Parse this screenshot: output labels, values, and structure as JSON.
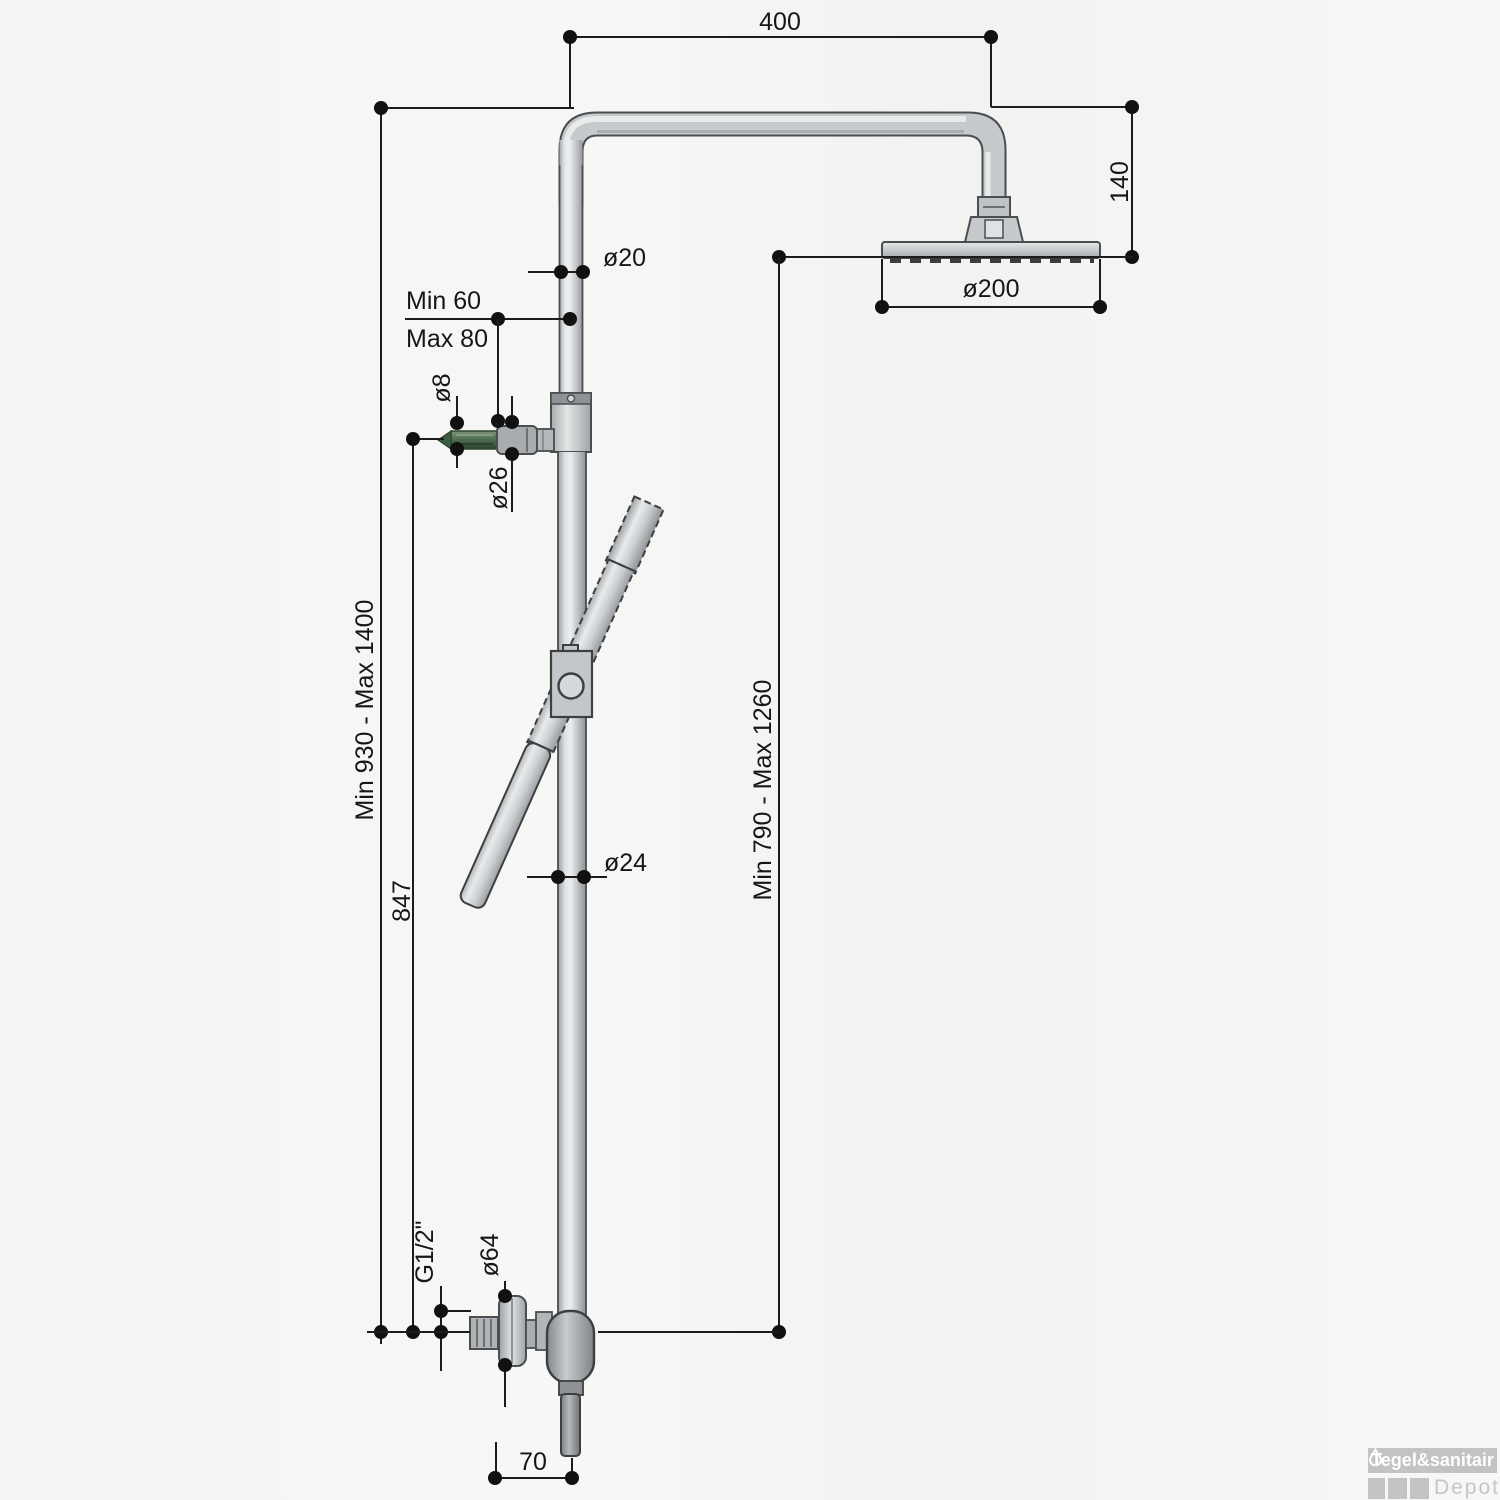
{
  "drawing": {
    "type": "technical-dimension-diagram",
    "subject": "shower column with rain shower head, hand shower and wall-mounted mixer",
    "units": "mm",
    "dimensions": {
      "arm_width": "400",
      "head_drop": "140",
      "riser_upper_diameter": "ø20",
      "wall_bracket_min": "Min 60",
      "wall_bracket_max": "Max 80",
      "bracket_screw_diameter": "ø8",
      "bracket_collar_diameter": "ø26",
      "head_diameter": "ø200",
      "column_height_range": "Min 930 - Max 1400",
      "bracket_height": "847",
      "riser_lower_diameter": "ø24",
      "head_height_range": "Min 790 - Max 1260",
      "inlet_thread": "G1/2\"",
      "mixer_flange_diameter": "ø64",
      "hose_offset": "70"
    },
    "colors": {
      "line": "#1c1c1c",
      "metal_light": "#eceeef",
      "metal_mid": "#c3c7ca",
      "metal_dark": "#84888b",
      "screw_green": "#44634a"
    }
  },
  "logo": {
    "brand": "Tegel&sanitair",
    "sub": "Depot"
  }
}
